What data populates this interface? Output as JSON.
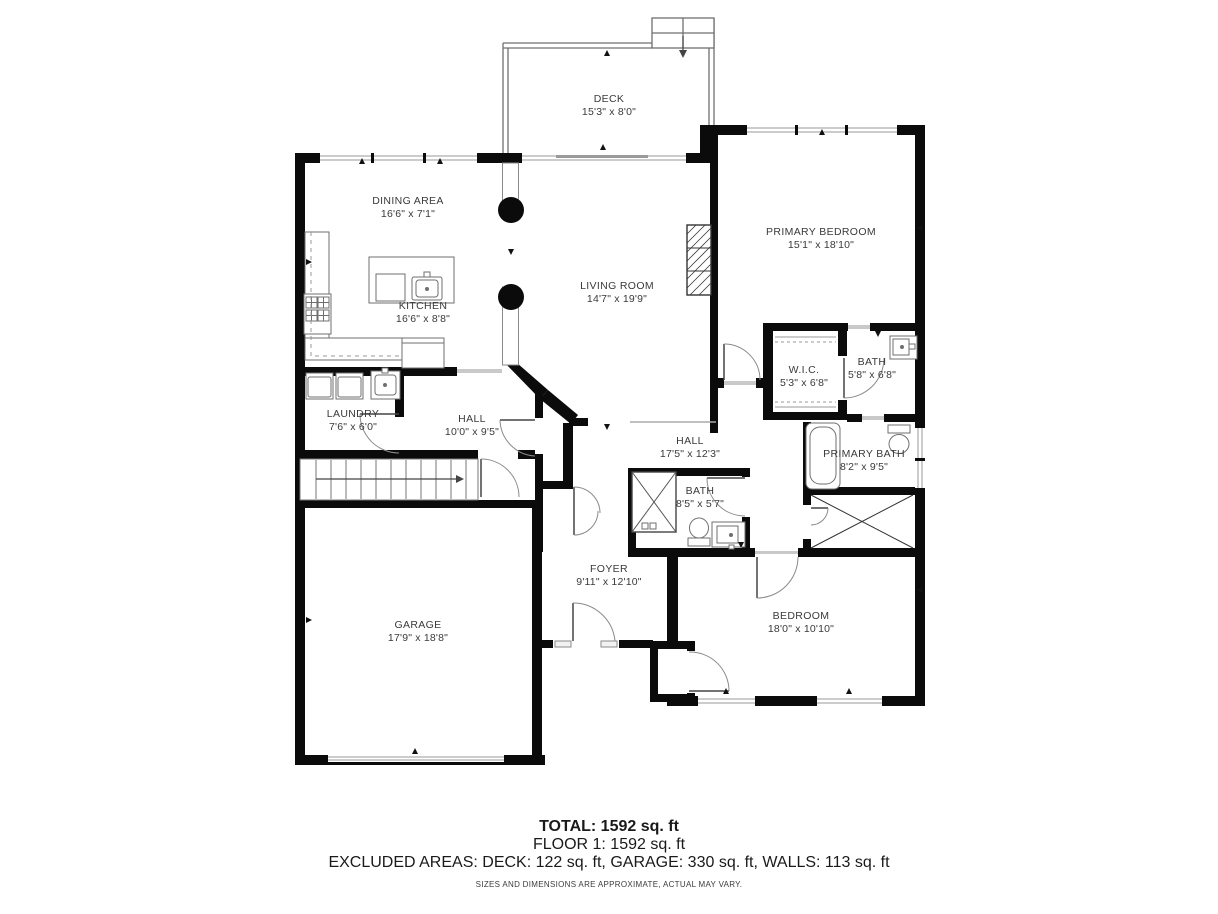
{
  "plan": {
    "rooms": [
      {
        "id": "deck",
        "name": "DECK",
        "dims": "15'3\" x 8'0\""
      },
      {
        "id": "dining-area",
        "name": "DINING AREA",
        "dims": "16'6\" x 7'1\""
      },
      {
        "id": "kitchen",
        "name": "KITCHEN",
        "dims": "16'6\" x 8'8\""
      },
      {
        "id": "living-room",
        "name": "LIVING ROOM",
        "dims": "14'7\" x 19'9\""
      },
      {
        "id": "primary-bedroom",
        "name": "PRIMARY BEDROOM",
        "dims": "15'1\" x 18'10\""
      },
      {
        "id": "wic",
        "name": "W.I.C.",
        "dims": "5'3\" x 6'8\""
      },
      {
        "id": "bath",
        "name": "BATH",
        "dims": "5'8\" x 6'8\""
      },
      {
        "id": "laundry",
        "name": "LAUNDRY",
        "dims": "7'6\" x 6'0\""
      },
      {
        "id": "hall-small",
        "name": "HALL",
        "dims": "10'0\" x 9'5\""
      },
      {
        "id": "hall-main",
        "name": "HALL",
        "dims": "17'5\" x 12'3\""
      },
      {
        "id": "primary-bath",
        "name": "PRIMARY BATH",
        "dims": "8'2\" x 9'5\""
      },
      {
        "id": "bath-2",
        "name": "BATH",
        "dims": "8'5\" x 5'7\""
      },
      {
        "id": "foyer",
        "name": "FOYER",
        "dims": "9'11\" x 12'10\""
      },
      {
        "id": "garage",
        "name": "GARAGE",
        "dims": "17'9\" x 18'8\""
      },
      {
        "id": "bedroom",
        "name": "BEDROOM",
        "dims": "18'0\" x 10'10\""
      }
    ],
    "summary": {
      "total": "TOTAL: 1592 sq. ft",
      "floor": "FLOOR 1: 1592 sq. ft",
      "excluded": "EXCLUDED AREAS: DECK: 122 sq. ft, GARAGE: 330 sq. ft, WALLS: 113 sq. ft"
    },
    "disclaimer": "SIZES AND DIMENSIONS ARE APPROXIMATE, ACTUAL MAY VARY.",
    "colors": {
      "wall": "#0b0b0b",
      "fixture_line": "#6f6f6f",
      "door_arc": "#8a8a8a",
      "label": "#3a3a3a"
    }
  }
}
